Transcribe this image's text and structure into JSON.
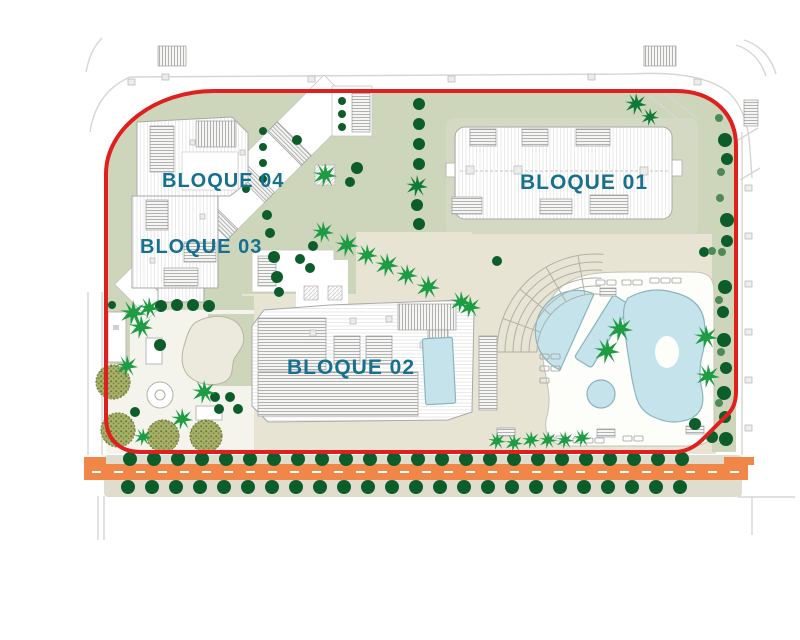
{
  "plan": {
    "title": "site-plan",
    "labels": {
      "bloque01": "BLOQUE 01",
      "bloque02": "BLOQUE 02",
      "bloque03": "BLOQUE 03",
      "bloque04": "BLOQUE 04"
    }
  },
  "colors": {
    "boundary_red": "#e01f1f",
    "label_blue": "#17708f",
    "ground_green": "#cdd6ba",
    "pad_green": "#d4d9c3",
    "path_beige": "#e7e4d4",
    "sidewalk_beige": "#dfddcd",
    "pool_blue": "#c5e3eb",
    "pool_edge": "#8ab4bf",
    "road_orange": "#f08748",
    "tree_dark": "#0d5d2b",
    "palm_green": "#1d9c43",
    "olive_green": "#a8b267",
    "building_line": "#a9a9a9"
  }
}
